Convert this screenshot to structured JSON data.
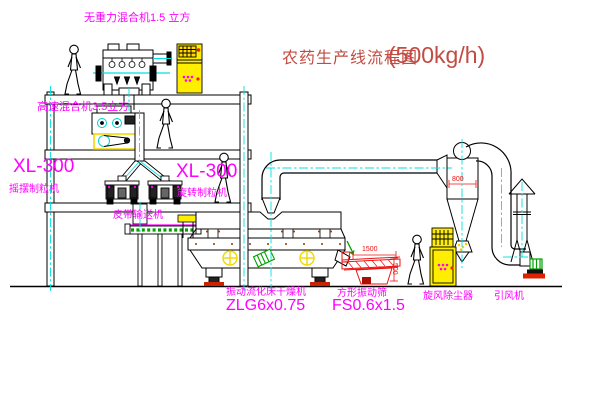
{
  "title": {
    "text": "农药生产线流程图",
    "capacity": "(500kg/h)"
  },
  "equipment_labels": {
    "gravity_mixer": "无重力混合机1.5 立方",
    "high_speed_mixer": "高速混合机3.5立方",
    "granulator_left": {
      "model": "XL-300",
      "name": "摇摆制粒机"
    },
    "granulator_right": {
      "model": "XL-300",
      "name": "旋转制粒机"
    },
    "belt_conveyor": "皮带输送机",
    "fluid_bed_dryer": {
      "name": "振动流化床干燥机",
      "model": "ZLG6x0.75"
    },
    "vibrating_sieve": {
      "name": "方形振动筛",
      "model": "FS0.6x1.5"
    },
    "cyclone": "旋风除尘器",
    "induced_draft_fan": "引风机"
  },
  "dimensions": {
    "sieve_length_mm": "1500",
    "sieve_height_mm": "500",
    "cyclone_dia_mm": "800"
  },
  "colors": {
    "label": "#ff00ff",
    "title": "#c24b42",
    "line": "#000000",
    "centerline": "#00e0e0",
    "accent_yellow": "#ffee00",
    "dimension_red": "#ee1111",
    "accent_green": "#00a000",
    "background": "#ffffff"
  }
}
